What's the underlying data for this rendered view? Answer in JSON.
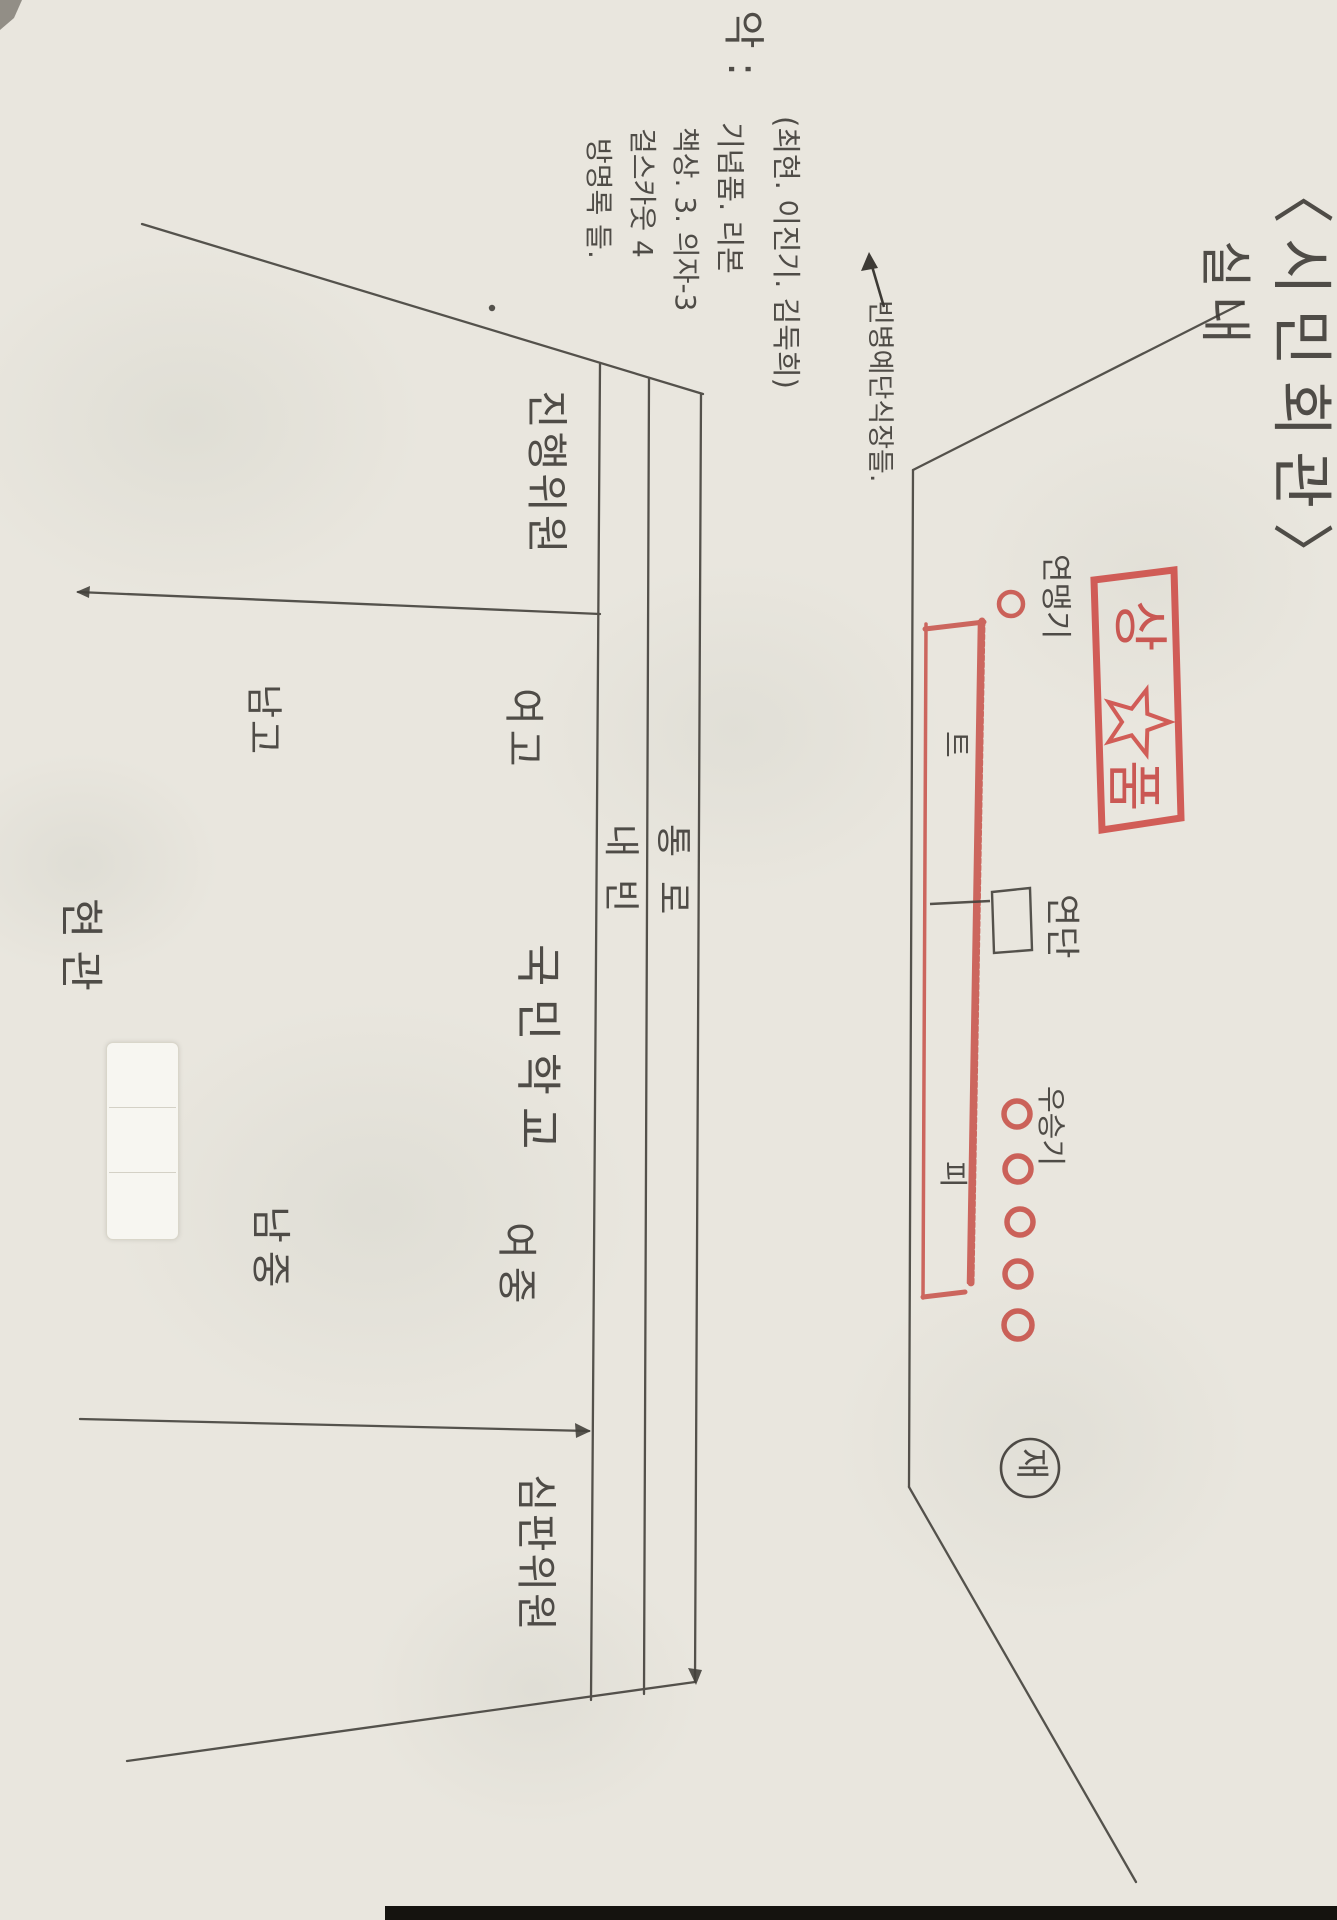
{
  "document": {
    "title": {
      "main": "〈시민회관〉",
      "sub": "실내"
    },
    "memo": {
      "header": "악 :",
      "items": [
        "(최현. 이진기. 김둑희)",
        "기념품. 리본",
        "책상. 3. 의자-3",
        "걸스카웃 4",
        "방명록 들."
      ],
      "arrow_note": "빈병예단식장들."
    },
    "hall": {
      "entrance": "현관",
      "front_rows": [
        "내빈",
        "통로"
      ],
      "sections": [
        {
          "label": "진행위원"
        },
        {
          "label": "남고"
        },
        {
          "label": "여고"
        },
        {
          "label": "국민학교"
        },
        {
          "label": "남중"
        },
        {
          "label": "여중"
        },
        {
          "label": "심판위원"
        }
      ]
    },
    "stage": {
      "flag_label": "연맹기",
      "podium_label": "연단",
      "winners_flag_label": "우승기",
      "platform_marks": [
        "트",
        "피"
      ],
      "stamp": {
        "chars": [
          "상",
          "품"
        ],
        "icon": "star"
      },
      "circled_mark": "재"
    },
    "colors": {
      "paper": "#e9e6de",
      "pencil": "#3a3733",
      "red_crayon": "#c5403c"
    }
  }
}
